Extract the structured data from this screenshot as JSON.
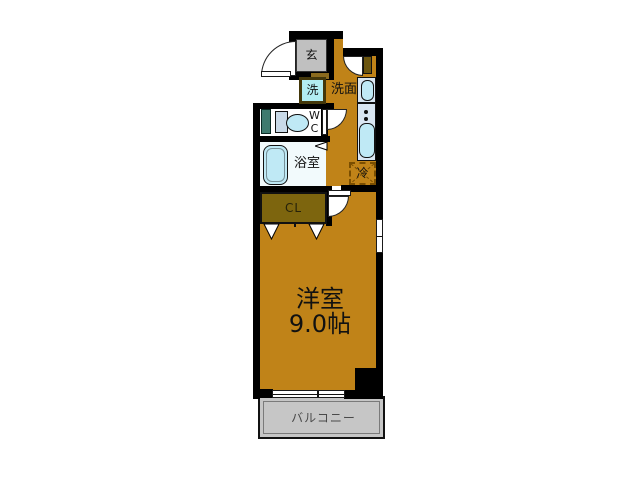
{
  "plan": {
    "type": "floor-plan",
    "rooms": {
      "genkan": {
        "label": "玄"
      },
      "laundry": {
        "label": "洗"
      },
      "washroom": {
        "label": "洗面"
      },
      "wc": {
        "label_line1": "W",
        "label_line2": "C"
      },
      "bathroom": {
        "label": "浴室"
      },
      "closet": {
        "label": "CL"
      },
      "fridge_space": {
        "label": "冷"
      },
      "main_room": {
        "label": "洋室",
        "size": "9.0帖"
      },
      "balcony": {
        "label": "バルコニー"
      }
    },
    "colors": {
      "floor_orange": "#C08318",
      "wall_black": "#000000",
      "genkan_gray": "#C0C0C0",
      "balcony_gray": "#C6C6C6",
      "closet_olive": "#7D650E",
      "fixture_cyan": "#BFE9F5",
      "kitchen_counter": "#D9E6F2",
      "pipe_space_teal": "#3F7A6E",
      "fridge_dash_brown": "#7A4E00"
    }
  }
}
